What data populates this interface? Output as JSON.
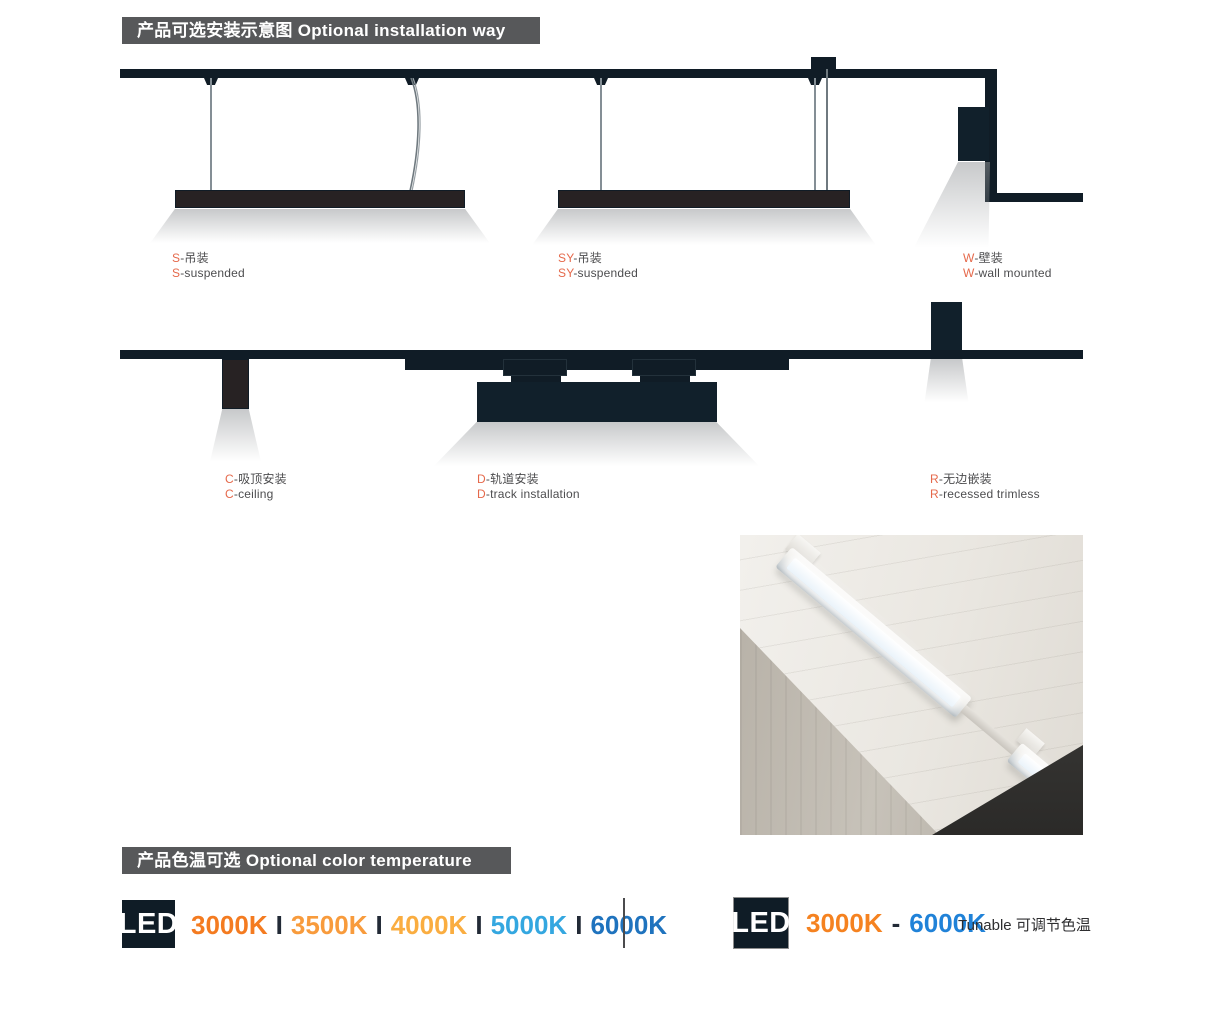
{
  "colors": {
    "banner_bg": "#57585A",
    "banner_text": "#FFFFFF",
    "diagram_dark": "#101C26",
    "fixture_dark": "#272223",
    "label_text": "#4D4D4F",
    "label_accent": "#E5694B",
    "cct_separator": "#222A36",
    "led_badge_bg": "#0F1C26",
    "led_badge_text": "#FFFFFF"
  },
  "installation": {
    "header": "产品可选安装示意图 Optional installation way",
    "items": [
      {
        "prefix": "S",
        "zh": "-吊装",
        "en": "-suspended"
      },
      {
        "prefix": "SY",
        "zh": "-吊装",
        "en": "-suspended"
      },
      {
        "prefix": "W",
        "zh": "-壁装",
        "en": "-wall mounted"
      },
      {
        "prefix": "C",
        "zh": "-吸顶安装",
        "en": "-ceiling"
      },
      {
        "prefix": "D",
        "zh": "-轨道安装",
        "en": "-track installation"
      },
      {
        "prefix": "R",
        "zh": "-无边嵌装",
        "en": "-recessed trimless"
      }
    ]
  },
  "color_temperature": {
    "header": "产品色温可选 Optional color temperature",
    "led_label": "LED",
    "separator": "I",
    "fixed_options": [
      {
        "label": "3000K",
        "color": "#F47B20"
      },
      {
        "label": "3500K",
        "color": "#F89B3C"
      },
      {
        "label": "4000K",
        "color": "#FAAD40"
      },
      {
        "label": "5000K",
        "color": "#34A7E0"
      },
      {
        "label": "6000K",
        "color": "#1F73BE"
      }
    ],
    "tunable": {
      "from": "3000K",
      "from_color": "#F58220",
      "dash": "-",
      "to": "6000K",
      "to_color": "#2082D8",
      "note": "Tunable 可调节色温"
    }
  }
}
